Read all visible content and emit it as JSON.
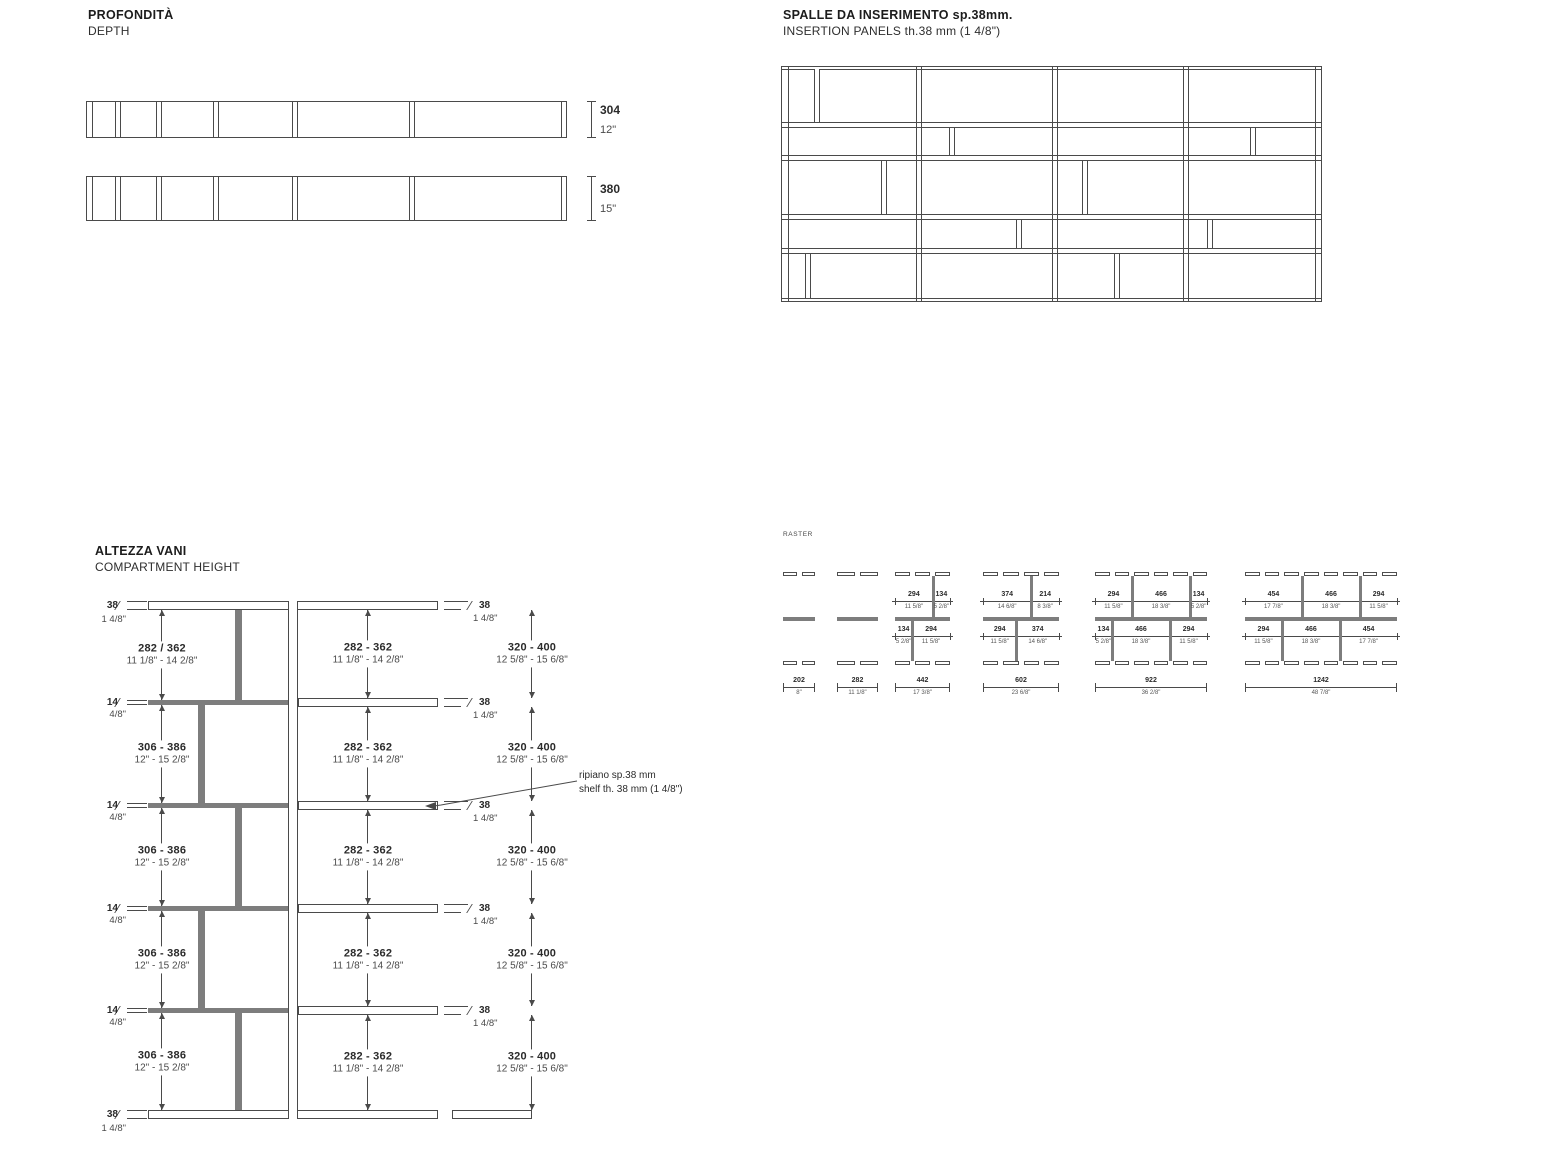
{
  "page": {
    "background": "#ffffff",
    "line_color": "#4a4a4a",
    "gray_fill": "#7d7d7d",
    "text_color": "#2b2b2b"
  },
  "depth": {
    "title": "PROFONDITÀ",
    "subtitle": "DEPTH",
    "bars": [
      {
        "mm": "304",
        "inches": "12\""
      },
      {
        "mm": "380",
        "inches": "15\""
      }
    ]
  },
  "insertion_panels": {
    "title": "SPALLE DA INSERIMENTO sp.38mm.",
    "subtitle": "INSERTION PANELS th.38 mm (1 4/8\")"
  },
  "compartment_height": {
    "title": "ALTEZZA VANI",
    "subtitle": "COMPARTMENT HEIGHT",
    "left_gaps": [
      {
        "mm": "282 / 362",
        "inches": "11 1/8\" - 14 2/8\""
      },
      {
        "mm": "306 - 386",
        "inches": "12\" - 15 2/8\""
      },
      {
        "mm": "306 - 386",
        "inches": "12\" - 15 2/8\""
      },
      {
        "mm": "306 - 386",
        "inches": "12\" - 15 2/8\""
      },
      {
        "mm": "306 - 386",
        "inches": "12\" - 15 2/8\""
      }
    ],
    "middle_gaps": [
      {
        "mm": "282 - 362",
        "inches": "11 1/8\" - 14 2/8\""
      },
      {
        "mm": "282 - 362",
        "inches": "11 1/8\" - 14 2/8\""
      },
      {
        "mm": "282 - 362",
        "inches": "11 1/8\" - 14 2/8\""
      },
      {
        "mm": "282 - 362",
        "inches": "11 1/8\" - 14 2/8\""
      },
      {
        "mm": "282 - 362",
        "inches": "11 1/8\" - 14 2/8\""
      }
    ],
    "right_gaps": [
      {
        "mm": "320 - 400",
        "inches": "12 5/8\" - 15 6/8\""
      },
      {
        "mm": "320 - 400",
        "inches": "12 5/8\" - 15 6/8\""
      },
      {
        "mm": "320 - 400",
        "inches": "12 5/8\" - 15 6/8\""
      },
      {
        "mm": "320 - 400",
        "inches": "12 5/8\" - 15 6/8\""
      },
      {
        "mm": "320 - 400",
        "inches": "12 5/8\" - 15 6/8\""
      }
    ],
    "top_thickness": {
      "mm": "38",
      "inches": "1 4/8\""
    },
    "bottom_thickness": {
      "mm": "38",
      "inches": "1 4/8\""
    },
    "shelf_thickness": {
      "mm": "14",
      "inches": "4/8\""
    },
    "panel_thickness": {
      "mm": "38",
      "inches": "1 4/8\""
    },
    "annotation": {
      "line1": "ripiano sp.38 mm",
      "line2": "shelf th. 38 mm (1 4/8\")"
    }
  },
  "raster": {
    "title": "RASTER",
    "diagrams": [
      {
        "total_mm": "202",
        "total_in": "8\"",
        "above": [],
        "below": []
      },
      {
        "total_mm": "282",
        "total_in": "11 1/8\"",
        "above": [],
        "below": []
      },
      {
        "total_mm": "442",
        "total_in": "17 3/8\"",
        "above": [
          {
            "mm": "294",
            "inches": "11 5/8\""
          },
          {
            "mm": "134",
            "inches": "5 2/8\""
          }
        ],
        "below": [
          {
            "mm": "134",
            "inches": "5 2/8\""
          },
          {
            "mm": "294",
            "inches": "11 5/8\""
          }
        ]
      },
      {
        "total_mm": "602",
        "total_in": "23 6/8\"",
        "above": [
          {
            "mm": "374",
            "inches": "14 6/8\""
          },
          {
            "mm": "214",
            "inches": "8 3/8\""
          }
        ],
        "below": [
          {
            "mm": "294",
            "inches": "11 5/8\""
          },
          {
            "mm": "374",
            "inches": "14 6/8\""
          }
        ]
      },
      {
        "total_mm": "922",
        "total_in": "36 2/8\"",
        "above": [
          {
            "mm": "294",
            "inches": "11 5/8\""
          },
          {
            "mm": "466",
            "inches": "18 3/8\""
          },
          {
            "mm": "134",
            "inches": "5 2/8\""
          }
        ],
        "below": [
          {
            "mm": "134",
            "inches": "5 2/8\""
          },
          {
            "mm": "466",
            "inches": "18 3/8\""
          },
          {
            "mm": "294",
            "inches": "11 5/8\""
          }
        ]
      },
      {
        "total_mm": "1242",
        "total_in": "48 7/8\"",
        "above": [
          {
            "mm": "454",
            "inches": "17 7/8\""
          },
          {
            "mm": "466",
            "inches": "18 3/8\""
          },
          {
            "mm": "294",
            "inches": "11 5/8\""
          }
        ],
        "below": [
          {
            "mm": "294",
            "inches": "11 5/8\""
          },
          {
            "mm": "466",
            "inches": "18 3/8\""
          },
          {
            "mm": "454",
            "inches": "17 7/8\""
          }
        ]
      }
    ]
  }
}
